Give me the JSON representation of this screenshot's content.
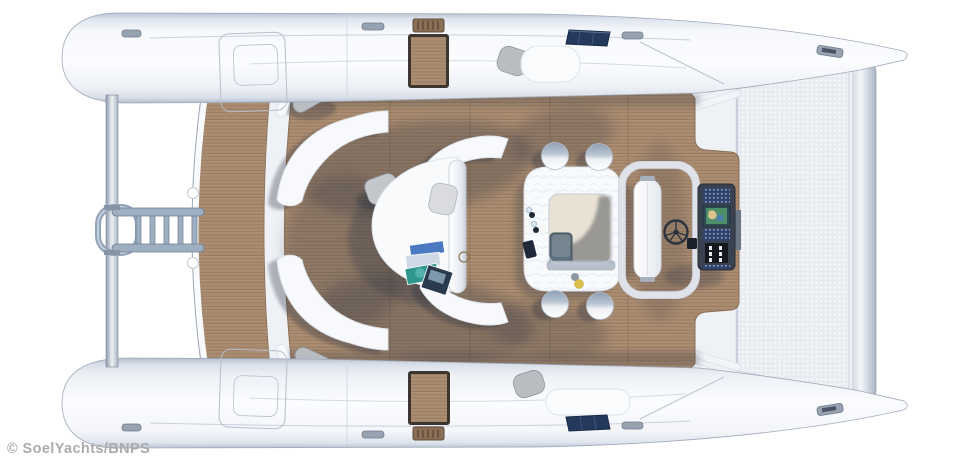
{
  "watermark": {
    "text": "© SoelYachts/BNPS"
  },
  "scene": {
    "subject": "solar electric catamaran yacht, top-down deck plan render",
    "view": "top-down",
    "elements": [
      "top-hull",
      "bottom-hull",
      "bow-trampoline",
      "forward-crossbeam",
      "teak-cockpit-deck",
      "aft-swim-platform",
      "boarding-ladder",
      "stern-rail-pole",
      "curved-bench-seating",
      "round-lounge-daybed",
      "lounge-pillows",
      "magazines",
      "c-shaped-bar-counter",
      "galley-skylight-hatch",
      "bar-stools",
      "windscreen-frame",
      "sunbed",
      "helm-wheel",
      "helm-console-chartplotter",
      "solar-panels",
      "fender-cushions",
      "boarding-step-pads",
      "deck-hatches",
      "cleats"
    ]
  },
  "colors": {
    "background": "#ffffff",
    "hull_white": "#f6f8fb",
    "hull_edge": "#9fa9b9",
    "teak": "#a98b70",
    "teak_line": "#8a6d54",
    "teak_dark_frame": "#3c362f",
    "shadow": "#2c3340",
    "bench_white": "#f7f9fc",
    "trampoline": "#e9ecf1",
    "trampoline_dot": "#fbfcfe",
    "solar_panel": "#24395b",
    "console": "#3a4250",
    "console_panel_blue": "#31436b",
    "screen_map_green": "#4d8f68",
    "wheel": "#2c333f",
    "metal": "#9fafc2",
    "fender_gray": "#b9bdc2",
    "bar_top": "#f8fafc",
    "bar_hole_floor": "#e9e2d4",
    "cabinet": "#5f707f",
    "magazine_blue": "#4a79c2",
    "magazine_teal": "#2f968e",
    "magazine_dark": "#2a3a4d",
    "lemon_yellow": "#d8c14f",
    "watermark_gray": "#ababab"
  }
}
